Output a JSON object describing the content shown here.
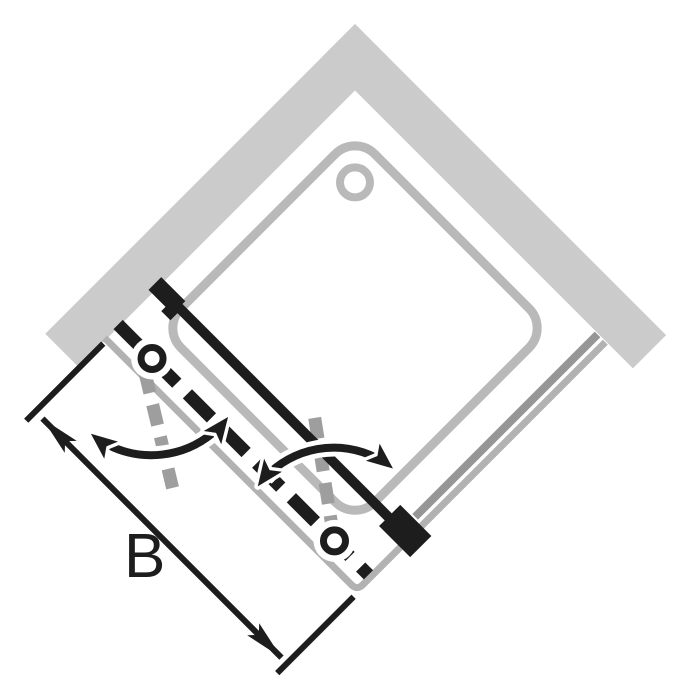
{
  "diagram": {
    "type": "shower-enclosure-top-view-technical-drawing",
    "description": "Top view of a corner shower enclosure: two walls meeting at a corner (rotated 45 degrees), square shower tray with drain, fixed side glass panel with wall bracket, double pivot pendulum door shown closed (solid line) and as dashed leaves with two pivot knobs, gray dashed open-door positions, double-headed swing arrows, and overall width dimension.",
    "dimension_label": "B"
  },
  "colors": {
    "background": "#ffffff",
    "wall": "#cbcbcb",
    "tray": "#b9b9b9",
    "frame": "#b2b2b2",
    "glass": "#969696",
    "glass_outer": "#bdbdbd",
    "open_position": "#9e9e9e",
    "ink": "#1d1d1d"
  }
}
